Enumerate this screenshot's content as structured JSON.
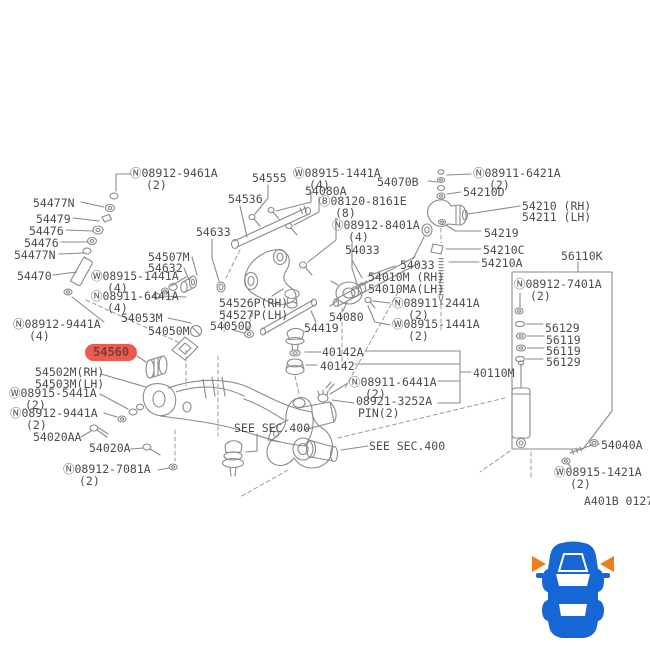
{
  "diagram": {
    "code": "A401B 0127",
    "highlighted_part": "54560",
    "highlight_color": "#ec5b52",
    "line_color": "#8a8a8a",
    "labels": {
      "n08912_9461a": {
        "text": "Ⓝ08912-9461A",
        "sub": "(2)"
      },
      "w08915_1441a_a": {
        "text": "Ⓦ08915-1441A",
        "sub": "(4)"
      },
      "n08911_6421a": {
        "text": "Ⓝ08911-6421A",
        "sub": "(2)"
      },
      "p54555": {
        "text": "54555"
      },
      "p54070b": {
        "text": "54070B"
      },
      "p54080a": {
        "text": "54080A"
      },
      "p54210d": {
        "text": "54210D"
      },
      "p54536": {
        "text": "54536"
      },
      "b08120_8161e": {
        "text": "Ⓑ08120-8161E",
        "sub": "(8)"
      },
      "p54477n_a": {
        "text": "54477N"
      },
      "p54210rh": {
        "text": "54210 (RH)"
      },
      "p54211lh": {
        "text": "54211 (LH)"
      },
      "p54479": {
        "text": "54479"
      },
      "n08912_8401a": {
        "text": "Ⓝ08912-8401A",
        "sub": "(4)"
      },
      "p54476_a": {
        "text": "54476"
      },
      "p54633": {
        "text": "54633"
      },
      "p54219": {
        "text": "54219"
      },
      "p54476_b": {
        "text": "54476"
      },
      "p54210c": {
        "text": "54210C"
      },
      "p56110k": {
        "text": "56110K"
      },
      "p54477n_b": {
        "text": "54477N"
      },
      "p54507m": {
        "text": "54507M"
      },
      "p54210a": {
        "text": "54210A"
      },
      "p54632": {
        "text": "54632"
      },
      "p54033_a": {
        "text": "54033"
      },
      "p54033_b": {
        "text": "54033"
      },
      "p54470": {
        "text": "54470"
      },
      "w08915_1441a_b": {
        "text": "Ⓦ08915-1441A",
        "sub": "(4)"
      },
      "p54010m": {
        "text": "54010M (RH)"
      },
      "n08912_7401a": {
        "text": "Ⓝ08912-7401A",
        "sub": "(2)"
      },
      "p54010ma": {
        "text": "54010MA(LH)"
      },
      "n08911_6441a_a": {
        "text": "Ⓝ08911-6441A",
        "sub": "(4)"
      },
      "n08911_2441a": {
        "text": "Ⓝ08911-2441A",
        "sub": "(2)"
      },
      "p54526p": {
        "text": "54526P(RH)"
      },
      "p54527p": {
        "text": "54527P(LH)"
      },
      "p54053m": {
        "text": "54053M"
      },
      "p54080": {
        "text": "54080"
      },
      "w08915_1441a_c": {
        "text": "Ⓦ08915-1441A",
        "sub": "(2)"
      },
      "n08912_9441a_a": {
        "text": "Ⓝ08912-9441A",
        "sub": "(4)"
      },
      "p54050d": {
        "text": "54050D"
      },
      "p56129_a": {
        "text": "56129"
      },
      "p54419": {
        "text": "54419"
      },
      "p54050m": {
        "text": "54050M"
      },
      "p56119_a": {
        "text": "56119"
      },
      "p56119_b": {
        "text": "56119"
      },
      "p40142a": {
        "text": "40142A"
      },
      "p54560": {
        "text": "54560"
      },
      "p56129_b": {
        "text": "56129"
      },
      "p40142": {
        "text": "40142"
      },
      "p54502m": {
        "text": "54502M(RH)"
      },
      "p40110m": {
        "text": "40110M"
      },
      "n08911_6441a_b": {
        "text": "Ⓝ08911-6441A",
        "sub": "(2)"
      },
      "p54503m": {
        "text": "54503M(LH)"
      },
      "w08915_5441a": {
        "text": "Ⓦ08915-5441A",
        "sub": "(2)"
      },
      "p08921_3252a": {
        "text": "08921-3252A",
        "sub": "PIN(2)"
      },
      "n08912_9441a_b": {
        "text": "Ⓝ08912-9441A",
        "sub": "(2)"
      },
      "see_sec_a": {
        "text": "SEE SEC.400"
      },
      "p54020aa": {
        "text": "54020AA"
      },
      "see_sec_b": {
        "text": "SEE SEC.400"
      },
      "p54040a": {
        "text": "54040A"
      },
      "p54020a": {
        "text": "54020A"
      },
      "n08912_7081a": {
        "text": "Ⓝ08912-7081A",
        "sub": "(2)"
      },
      "w08915_1421a": {
        "text": "Ⓦ08915-1421A",
        "sub": "(2)"
      },
      "a401b_code": {
        "text": "A401B 0127"
      }
    }
  },
  "car_icon": {
    "body_color": "#1766d6",
    "arrow_color": "#ef7d1d",
    "meaning": "front-suspension-location-indicator"
  }
}
